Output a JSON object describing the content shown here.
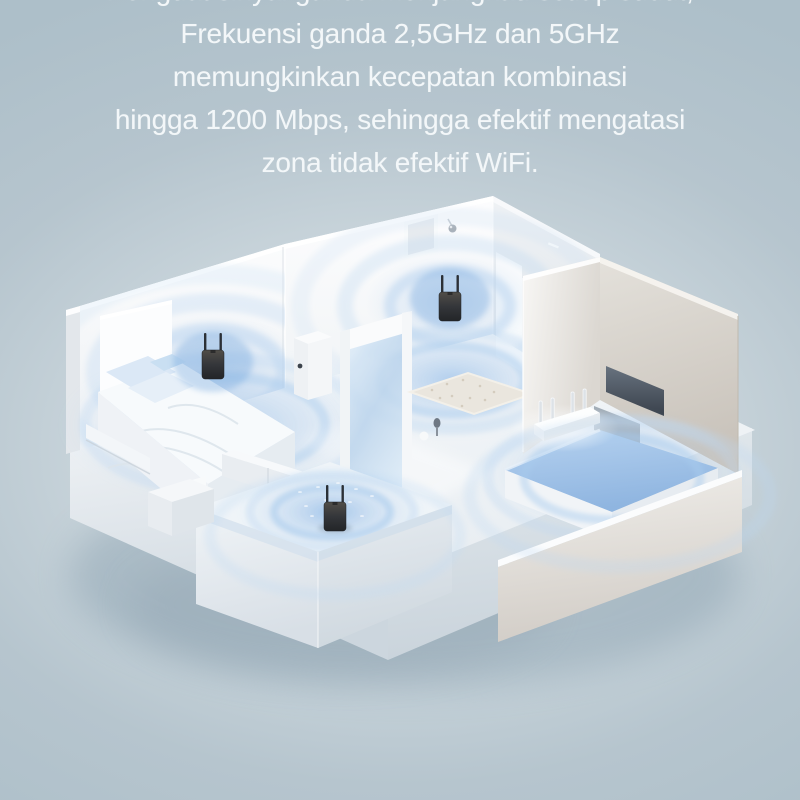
{
  "canvas": {
    "width": 800,
    "height": 800,
    "background_top": "#aec0c9",
    "background_center": "#d9e1e6",
    "background_bottom": "#b2c2cc"
  },
  "headline": {
    "text_color": "#f3f7f9",
    "line_clipped_top": "Penguat sinyal ganda menjangkau setiap sudut,",
    "lines": [
      "Frekuensi ganda 2,5GHz dan 5GHz",
      "memungkinkan kecepatan kombinasi",
      "hingga 1200 Mbps, sehingga efektif mengatasi",
      "zona tidak efektif WiFi."
    ]
  },
  "scene": {
    "type": "isometric-apartment-cutaway",
    "signal_color": "#8fb8e6",
    "signal_ring_color": "#b5d3f0",
    "wall_color": "#f5f7f9",
    "wall_shaded_color": "#e8ecef",
    "accent_wall_color": "#d5d0c8",
    "floor_color": "#f2f5f8",
    "device_dark_color": "#31363c",
    "router_color": "#f4f3f0",
    "rooms": [
      "bedroom",
      "living-room",
      "bedroom-2",
      "balcony"
    ],
    "devices": [
      {
        "name": "wifi-extender-bedroom",
        "antennas": 2
      },
      {
        "name": "wifi-extender-living",
        "antennas": 2
      },
      {
        "name": "wifi-extender-balcony",
        "antennas": 2
      },
      {
        "name": "wifi-router",
        "antennas": 4
      }
    ]
  }
}
